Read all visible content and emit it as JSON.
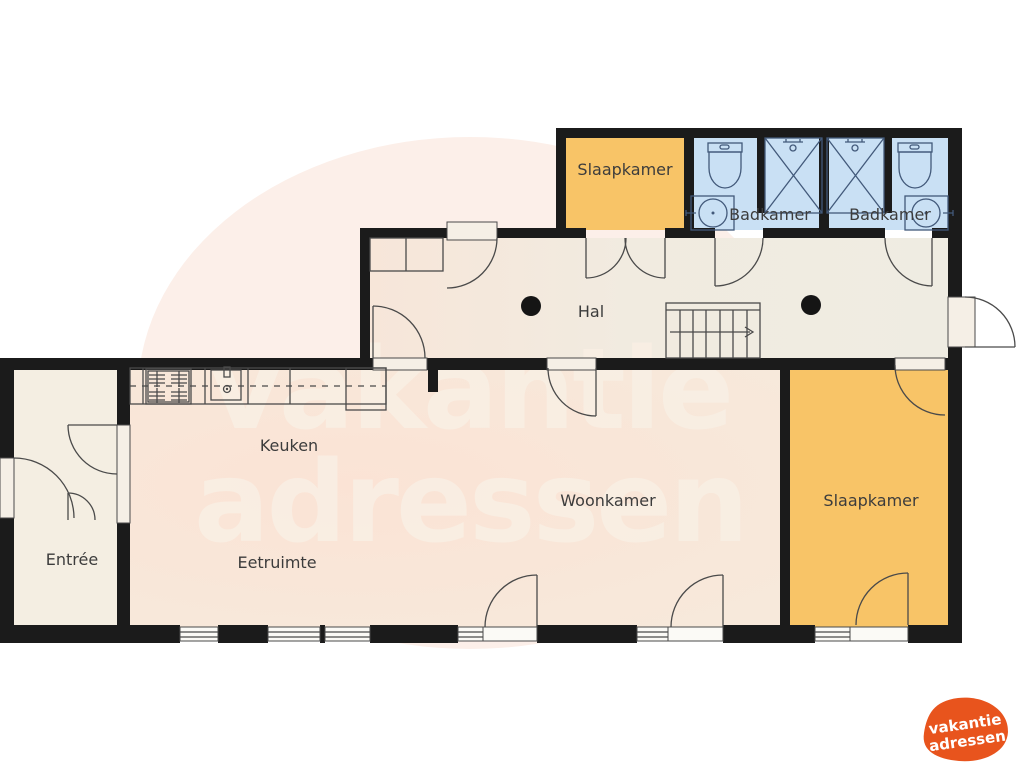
{
  "rooms": {
    "bedroom_top": {
      "label": "Slaapkamer"
    },
    "bathroom_left": {
      "label": "Badkamer"
    },
    "bathroom_right": {
      "label": "Badkamer"
    },
    "hall": {
      "label": "Hal"
    },
    "kitchen": {
      "label": "Keuken"
    },
    "dining": {
      "label": "Eetruimte"
    },
    "living": {
      "label": "Woonkamer"
    },
    "entry": {
      "label": "Entrée"
    },
    "bedroom_right": {
      "label": "Slaapkamer"
    }
  },
  "watermark": {
    "line1": "vakantie",
    "line2": "adressen"
  },
  "logo": {
    "line1": "vakantie",
    "line2": "adressen"
  },
  "colors": {
    "wall": "#1b1b1b",
    "bedroom_fill": "#f8c467",
    "bathroom_fill": "#c9e0f4",
    "hall_fill": "#f1ebe0",
    "living_fill": "#f9e5d8",
    "entry_fill": "#f4eee2",
    "background_circle": "#fcefe9",
    "watermark_text": "#f9efe4",
    "logo_orange": "#e8541d"
  }
}
